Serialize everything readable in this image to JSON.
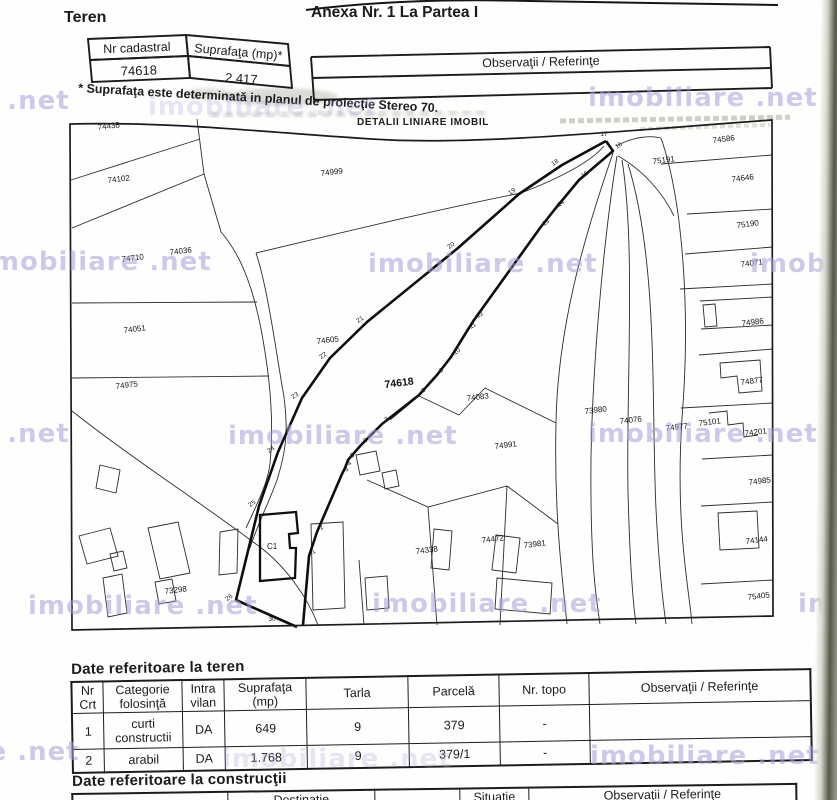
{
  "header": {
    "section_label": "Teren",
    "annex_title": "Anexa Nr. 1 La Partea I"
  },
  "cadastral_table": {
    "col_nr_cadastral": "Nr cadastral",
    "col_suprafata": "Suprafaţa (mp)*",
    "nr_cadastral": "74618",
    "suprafata": "2.417",
    "col_observatii": "Observaţii / Referinţe",
    "footnote": "* Suprafaţa este determinată in planul de proiecţie Stereo 70."
  },
  "map": {
    "title": "DETALII LINIARE IMOBIL",
    "building_label": "C1",
    "parcels": [
      {
        "t": "74438",
        "x": 38,
        "y": 22
      },
      {
        "t": "74102",
        "x": 48,
        "y": 75
      },
      {
        "t": "74036",
        "x": 110,
        "y": 147
      },
      {
        "t": "74710",
        "x": 62,
        "y": 154
      },
      {
        "t": "74051",
        "x": 64,
        "y": 225
      },
      {
        "t": "74975",
        "x": 56,
        "y": 281
      },
      {
        "t": "74999",
        "x": 261,
        "y": 68
      },
      {
        "t": "74605",
        "x": 257,
        "y": 236
      },
      {
        "t": "74618",
        "x": 325,
        "y": 280,
        "big": true
      },
      {
        "t": "74083",
        "x": 407,
        "y": 293
      },
      {
        "t": "74991",
        "x": 435,
        "y": 341
      },
      {
        "t": "73980",
        "x": 525,
        "y": 306
      },
      {
        "t": "74076",
        "x": 560,
        "y": 316
      },
      {
        "t": "74977",
        "x": 606,
        "y": 323
      },
      {
        "t": "75101",
        "x": 639,
        "y": 318
      },
      {
        "t": "74201",
        "x": 685,
        "y": 328
      },
      {
        "t": "74985",
        "x": 689,
        "y": 377
      },
      {
        "t": "74144",
        "x": 686,
        "y": 436
      },
      {
        "t": "75405",
        "x": 688,
        "y": 492
      },
      {
        "t": "74586",
        "x": 653,
        "y": 35
      },
      {
        "t": "75191",
        "x": 593,
        "y": 56
      },
      {
        "t": "74646",
        "x": 672,
        "y": 74
      },
      {
        "t": "75190",
        "x": 677,
        "y": 120
      },
      {
        "t": "74071",
        "x": 681,
        "y": 159
      },
      {
        "t": "74986",
        "x": 682,
        "y": 218
      },
      {
        "t": "74877",
        "x": 681,
        "y": 277
      },
      {
        "t": "73298",
        "x": 105,
        "y": 486
      },
      {
        "t": "74338",
        "x": 356,
        "y": 446
      },
      {
        "t": "74472",
        "x": 422,
        "y": 435
      },
      {
        "t": "73981",
        "x": 464,
        "y": 440
      }
    ],
    "vertices": [
      {
        "n": "17",
        "x": 546,
        "y": 33,
        "s": "t"
      },
      {
        "n": "18",
        "x": 502,
        "y": 57,
        "s": "l"
      },
      {
        "n": "19",
        "x": 459,
        "y": 86,
        "s": "l"
      },
      {
        "n": "20",
        "x": 398,
        "y": 140,
        "s": "l"
      },
      {
        "n": "21",
        "x": 307,
        "y": 214,
        "s": "l"
      },
      {
        "n": "22",
        "x": 270,
        "y": 250,
        "s": "l"
      },
      {
        "n": "23",
        "x": 242,
        "y": 290,
        "s": "l"
      },
      {
        "n": "24",
        "x": 218,
        "y": 344,
        "s": "l"
      },
      {
        "n": "25",
        "x": 199,
        "y": 398,
        "s": "l"
      },
      {
        "n": "26",
        "x": 176,
        "y": 492,
        "s": "l"
      },
      {
        "n": "30",
        "x": 212,
        "y": 505,
        "s": "b"
      },
      {
        "n": "16",
        "x": 553,
        "y": 43,
        "s": "r"
      },
      {
        "n": "15",
        "x": 519,
        "y": 72,
        "s": "r"
      },
      {
        "n": "14",
        "x": 495,
        "y": 101,
        "s": "r"
      },
      {
        "n": "13",
        "x": 480,
        "y": 120,
        "s": "r"
      },
      {
        "n": "12",
        "x": 414,
        "y": 212,
        "s": "r"
      },
      {
        "n": "11",
        "x": 407,
        "y": 223,
        "s": "r"
      },
      {
        "n": "10",
        "x": 391,
        "y": 249,
        "s": "r"
      },
      {
        "n": "9",
        "x": 377,
        "y": 267,
        "s": "r"
      },
      {
        "n": "8",
        "x": 359,
        "y": 287,
        "s": "r"
      },
      {
        "n": "7",
        "x": 322,
        "y": 316,
        "s": "r"
      },
      {
        "n": "6",
        "x": 301,
        "y": 337,
        "s": "r"
      },
      {
        "n": "5",
        "x": 288,
        "y": 352,
        "s": "r"
      },
      {
        "n": "4",
        "x": 285,
        "y": 360,
        "s": "r"
      },
      {
        "n": "3",
        "x": 282,
        "y": 366,
        "s": "r"
      },
      {
        "n": "2",
        "x": 257,
        "y": 424,
        "s": "r"
      },
      {
        "n": "1",
        "x": 249,
        "y": 448,
        "s": "r"
      }
    ]
  },
  "teren_table": {
    "title": "Date referitoare la teren",
    "headers": [
      "Nr\nCrt",
      "Categorie\nfolosinţă",
      "Intra\nvilan",
      "Suprafaţa\n(mp)",
      "Tarla",
      "Parcelă",
      "Nr. topo",
      "Observaţii / Referinţe"
    ],
    "rows": [
      [
        "1",
        "curti\nconstructii",
        "DA",
        "649",
        "9",
        "379",
        "-",
        ""
      ],
      [
        "2",
        "arabil",
        "DA",
        "1.768",
        "9",
        "379/1",
        "-",
        ""
      ]
    ]
  },
  "constructii_table": {
    "title": "Date referitoare la construcţii",
    "headers": [
      "",
      "Destinaţie",
      "",
      "Situaţie",
      "Observaţii / Referinţe"
    ]
  },
  "watermark": {
    "text": "imobiliare .net"
  }
}
